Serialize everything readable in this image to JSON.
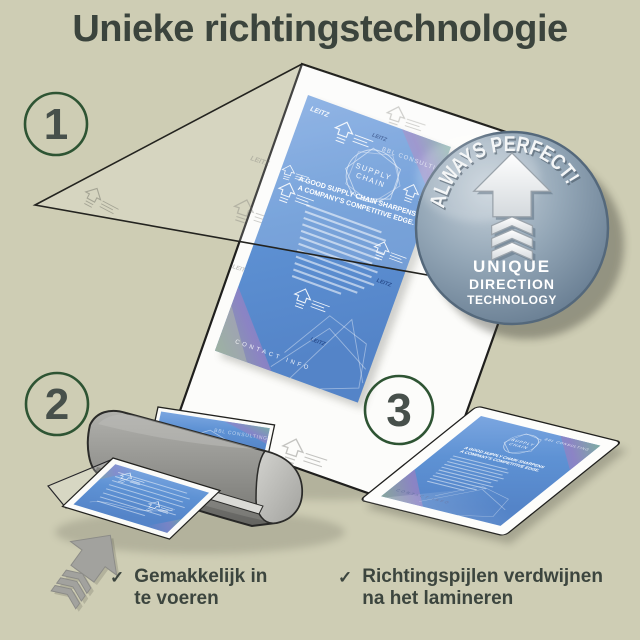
{
  "title": "Unieke richtingstechnologie",
  "steps": [
    {
      "number": "1"
    },
    {
      "number": "2"
    },
    {
      "number": "3"
    }
  ],
  "badge": {
    "arc_text": "ALWAYS PERFECT!",
    "word1": "UNIQUE",
    "word2": "DIRECTION",
    "word3": "TECHNOLOGY"
  },
  "flyer": {
    "brand": "LEITZ",
    "company": "BBL CONSULTING",
    "circle_line1": "SUPPLY",
    "circle_line2": "CHAIN",
    "headline1": "A GOOD SUPPLY CHAIN SHARPENS",
    "headline2": "A COMPANY'S COMPETITIVE EDGE.",
    "footer": "CONTACT INFO"
  },
  "checklist": [
    {
      "mark": "✓",
      "line1": "Gemakkelijk in",
      "line2": "te voeren"
    },
    {
      "mark": "✓",
      "line1": "Richtingspijlen verdwijnen",
      "line2": "na het lamineren"
    }
  ],
  "colors": {
    "background": "#cecdb4",
    "title_text": "#3b443d",
    "step_circle_border": "#2e5433",
    "step_number": "#47504b",
    "flyer_blue": "#5e92d4",
    "flyer_purple": "#8e83c4",
    "badge_light": "#c3cfd9",
    "badge_dark": "#5d7389",
    "machine_gray": "#949490",
    "check_text": "#3c453e",
    "brand_navy": "#1d3e7e"
  }
}
